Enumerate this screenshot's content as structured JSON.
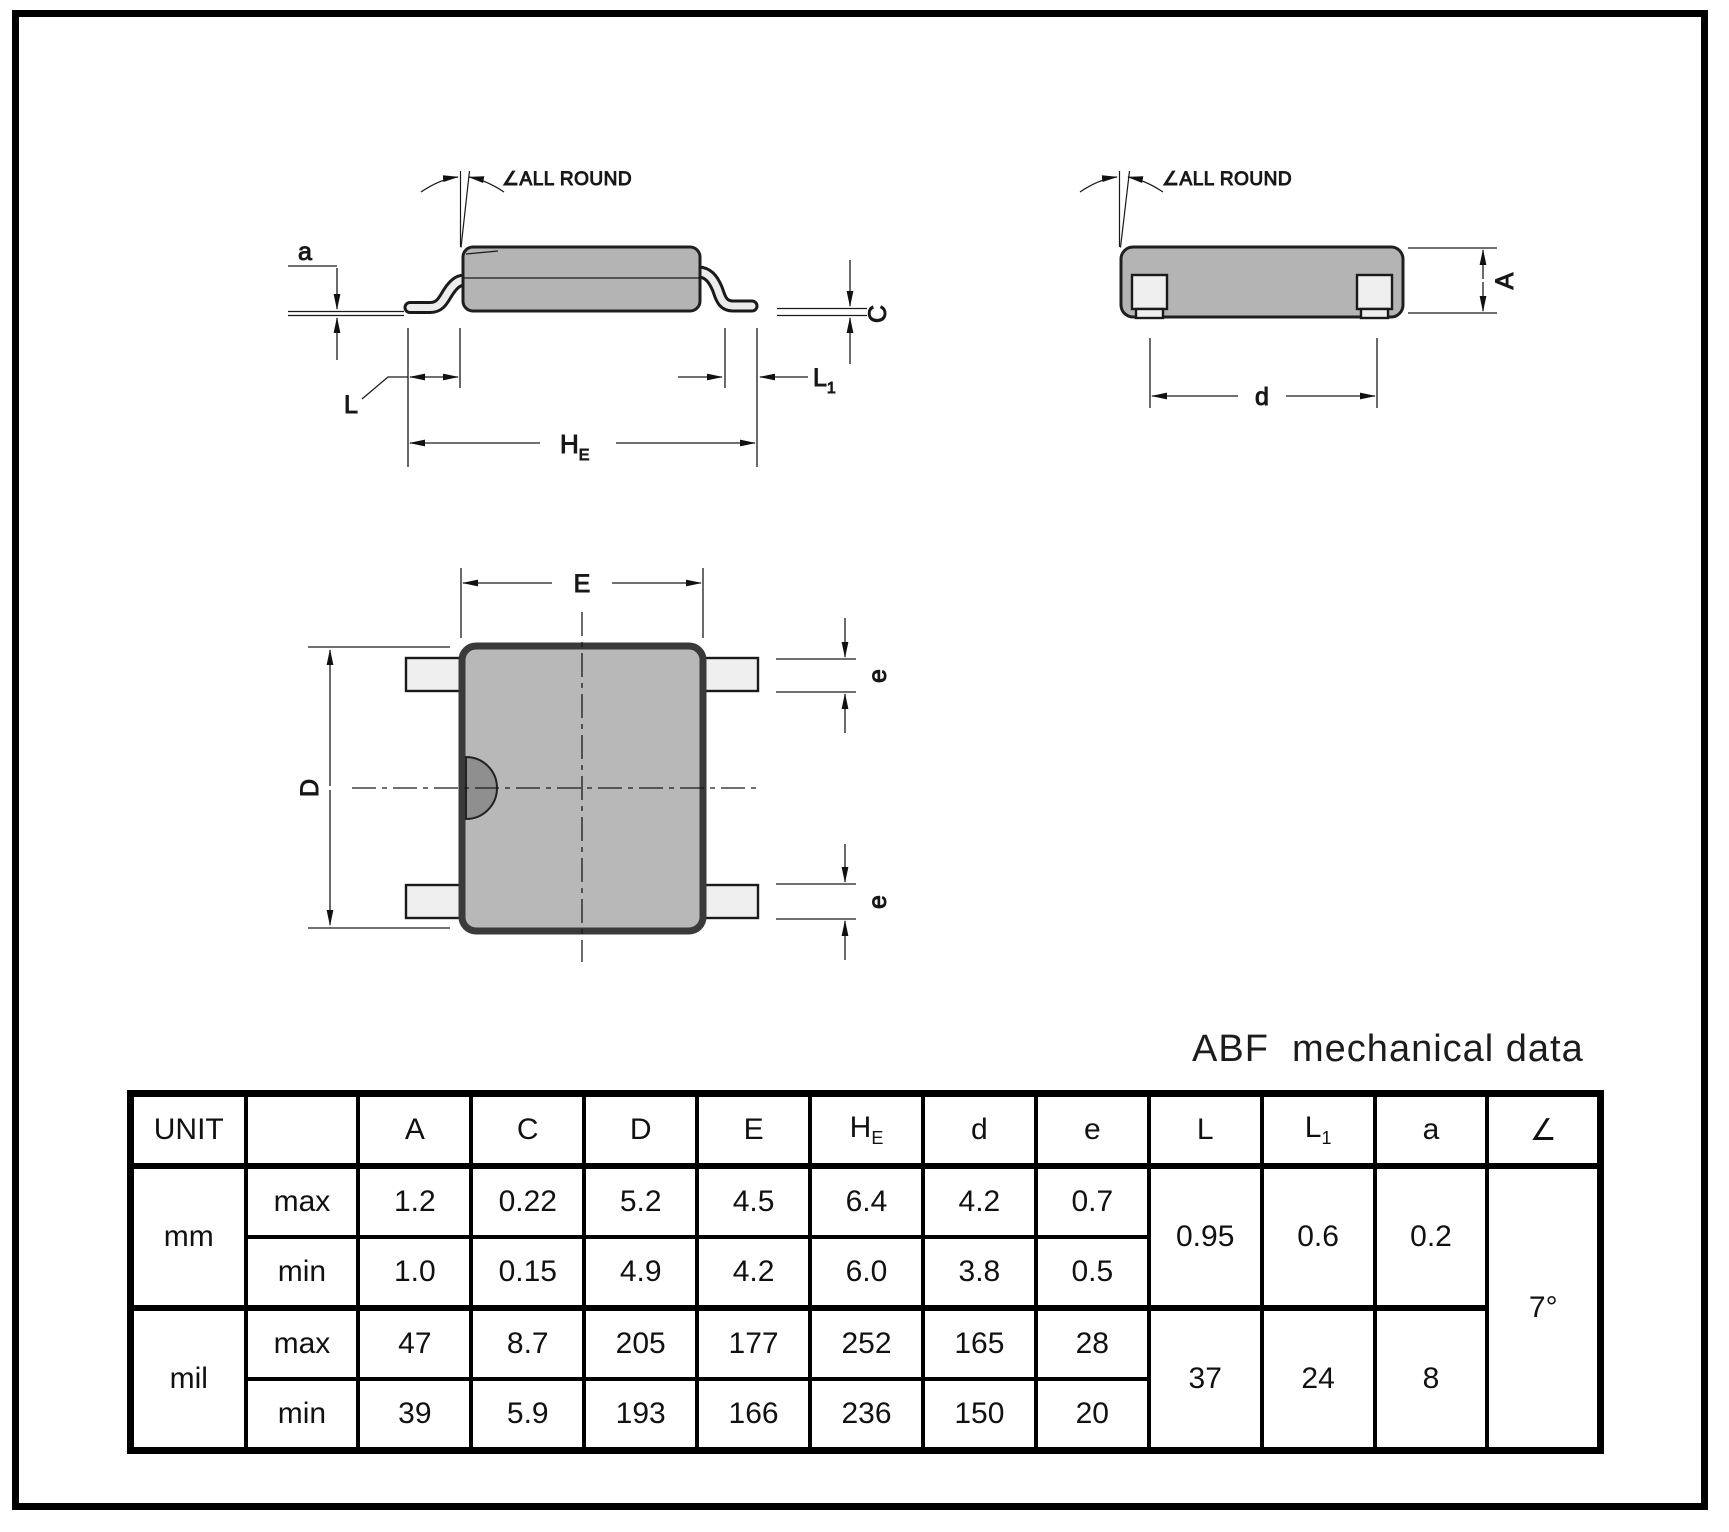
{
  "title": "ABF  mechanical data",
  "colors": {
    "body_fill": "#b4b4b4",
    "lead_fill": "#ededed",
    "notch_fill": "#8f8f8f",
    "line": "#111111"
  },
  "side_view": {
    "all_round": "∠ALL ROUND",
    "a": "a",
    "L": "L",
    "L1_base": "L",
    "L1_sub": "1",
    "HE_base": "H",
    "HE_sub": "E",
    "C": "C"
  },
  "end_view": {
    "all_round": "∠ALL ROUND",
    "d": "d",
    "A": "A"
  },
  "top_view": {
    "E": "E",
    "D": "D",
    "e_top": "e",
    "e_bottom": "e"
  },
  "table": {
    "headers": {
      "unit": "UNIT",
      "blank": "",
      "A": "A",
      "C": "C",
      "D": "D",
      "E": "E",
      "HE_base": "H",
      "HE_sub": "E",
      "d": "d",
      "e": "e",
      "L": "L",
      "L1_base": "L",
      "L1_sub": "1",
      "a": "a",
      "angle": "∠"
    },
    "mm": {
      "label": "mm",
      "max": {
        "label": "max",
        "A": "1.2",
        "C": "0.22",
        "D": "5.2",
        "E": "4.5",
        "HE": "6.4",
        "d": "4.2",
        "e": "0.7"
      },
      "min": {
        "label": "min",
        "A": "1.0",
        "C": "0.15",
        "D": "4.9",
        "E": "4.2",
        "HE": "6.0",
        "d": "3.8",
        "e": "0.5"
      },
      "L": "0.95",
      "L1": "0.6",
      "a": "0.2"
    },
    "mil": {
      "label": "mil",
      "max": {
        "label": "max",
        "A": "47",
        "C": "8.7",
        "D": "205",
        "E": "177",
        "HE": "252",
        "d": "165",
        "e": "28"
      },
      "min": {
        "label": "min",
        "A": "39",
        "C": "5.9",
        "D": "193",
        "E": "166",
        "HE": "236",
        "d": "150",
        "e": "20"
      },
      "L": "37",
      "L1": "24",
      "a": "8"
    },
    "angle_value": "7°"
  }
}
